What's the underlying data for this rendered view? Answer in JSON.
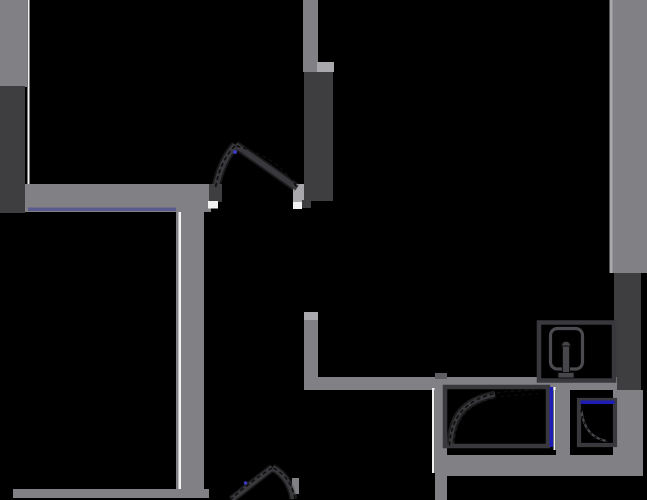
{
  "document": {
    "kind": "floor-plan",
    "width": 647,
    "height": 500,
    "background": "#000000"
  },
  "palette": {
    "bg": "#000000",
    "wall": "#818185",
    "wallLight": "#a9a9ad",
    "wallShadow": "#5f5f63",
    "dark": "#3e3e41",
    "white": "#f2f2f2",
    "purple": "#5a5a8e",
    "blue": "#1d1db5",
    "blueDot": "#3b3bc2",
    "black": "#000000",
    "stroke": "#39393d",
    "strokeLt": "#4a4a4f",
    "knob": "#46464b",
    "ink": "#0d0d0d",
    "halo": "#55555a"
  },
  "shapes": [
    {
      "type": "rect",
      "name": "wall-left-upper",
      "x": 0,
      "y": 0,
      "w": 27,
      "h": 87,
      "fill": "wall"
    },
    {
      "type": "rect",
      "name": "panel-left-dark",
      "x": 0,
      "y": 86,
      "w": 25,
      "h": 127,
      "fill": "dark"
    },
    {
      "type": "rect",
      "name": "wall-left-face-line",
      "x": 27.5,
      "y": 0,
      "w": 2,
      "h": 186,
      "fill": "white"
    },
    {
      "type": "rect",
      "name": "wall-entry-top",
      "x": 25,
      "y": 184,
      "w": 186,
      "h": 28,
      "fill": "wall"
    },
    {
      "type": "rect",
      "name": "accent-entry-purple",
      "x": 28,
      "y": 207.5,
      "w": 150,
      "h": 3.5,
      "fill": "purple"
    },
    {
      "type": "rect",
      "name": "wall-hall-vertical",
      "x": 176,
      "y": 205,
      "w": 28,
      "h": 293,
      "fill": "wall"
    },
    {
      "type": "rect",
      "name": "wall-hall-face-line",
      "x": 178.5,
      "y": 212,
      "w": 2.5,
      "h": 277,
      "fill": "white"
    },
    {
      "type": "rect",
      "name": "wall-bottom-left",
      "x": 13,
      "y": 489,
      "w": 196,
      "h": 9,
      "fill": "wall"
    },
    {
      "type": "rect",
      "name": "door1-jamb-left",
      "x": 209,
      "y": 184,
      "w": 13,
      "h": 18,
      "fill": "dark"
    },
    {
      "type": "rect",
      "name": "door1-sill-left",
      "x": 208,
      "y": 201,
      "w": 10,
      "h": 7.5,
      "fill": "white"
    },
    {
      "type": "rect",
      "name": "door1-jamb-right",
      "x": 293,
      "y": 184,
      "w": 18,
      "h": 18,
      "fill": "wallLight"
    },
    {
      "type": "rect",
      "name": "door1-sill-right",
      "x": 293,
      "y": 202,
      "w": 9,
      "h": 7,
      "fill": "white"
    },
    {
      "type": "rect",
      "name": "door1-jamb-right-dark",
      "x": 302,
      "y": 200,
      "w": 9,
      "h": 8,
      "fill": "dark"
    },
    {
      "type": "rect",
      "name": "wall-closet-top",
      "x": 303,
      "y": 0,
      "w": 15,
      "h": 72,
      "fill": "wall"
    },
    {
      "type": "rect",
      "name": "closet-cap",
      "x": 317,
      "y": 62,
      "w": 17,
      "h": 10,
      "fill": "wallLight"
    },
    {
      "type": "rect",
      "name": "panel-closet-dark",
      "x": 304,
      "y": 72,
      "w": 29,
      "h": 129,
      "fill": "dark"
    },
    {
      "type": "rect",
      "name": "wall-right-upper",
      "x": 612,
      "y": 0,
      "w": 35,
      "h": 273,
      "fill": "wall"
    },
    {
      "type": "rect",
      "name": "wall-right-face-line",
      "x": 609.5,
      "y": 0,
      "w": 3,
      "h": 273,
      "fill": "wallLight"
    },
    {
      "type": "rect",
      "name": "panel-right-dark",
      "x": 614,
      "y": 273,
      "w": 27,
      "h": 124,
      "fill": "dark"
    },
    {
      "type": "rect",
      "name": "wall-bath-corner-vertical",
      "x": 304,
      "y": 312,
      "w": 14,
      "h": 78,
      "fill": "wall"
    },
    {
      "type": "rect",
      "name": "bath-corner-cap",
      "x": 304,
      "y": 312,
      "w": 14,
      "h": 8,
      "fill": "wallLight"
    },
    {
      "type": "rect",
      "name": "wall-bath-top",
      "x": 310,
      "y": 377,
      "w": 307,
      "h": 13,
      "fill": "wall"
    },
    {
      "type": "rect",
      "name": "wall-bath-mid-vertical",
      "x": 435,
      "y": 373,
      "w": 12,
      "h": 127,
      "fill": "wall"
    },
    {
      "type": "rect",
      "name": "bath-mid-cap",
      "x": 435,
      "y": 373,
      "w": 12,
      "h": 6,
      "fill": "wallShadow"
    },
    {
      "type": "rect",
      "name": "wall-bath-mid-face-line",
      "x": 432,
      "y": 388,
      "w": 2.5,
      "h": 85,
      "fill": "white"
    },
    {
      "type": "rect",
      "name": "wall-bath-bottom",
      "x": 437,
      "y": 455,
      "w": 206,
      "h": 21,
      "fill": "wall"
    },
    {
      "type": "rect",
      "name": "wall-bath-right-lower",
      "x": 613,
      "y": 390,
      "w": 30,
      "h": 70,
      "fill": "wall"
    },
    {
      "type": "rect",
      "name": "wall-bath-divider",
      "x": 556,
      "y": 385,
      "w": 14,
      "h": 73,
      "fill": "wall"
    },
    {
      "type": "rect",
      "name": "bath-divider-face-line",
      "x": 553.5,
      "y": 387,
      "w": 2,
      "h": 63,
      "fill": "white"
    },
    {
      "type": "rect",
      "name": "door2-jamb-right",
      "x": 292,
      "y": 478,
      "w": 7,
      "h": 16,
      "fill": "wall"
    },
    {
      "type": "rect",
      "name": "washer-outline",
      "x": 539,
      "y": 322.5,
      "w": 75,
      "h": 58,
      "fill": "black",
      "stroke": "stroke",
      "sw": 4.5
    },
    {
      "type": "rect",
      "name": "washer-drum",
      "x": 550.5,
      "y": 328.5,
      "w": 32,
      "h": 40.5,
      "rx": 7,
      "fill": "black",
      "stroke": "strokeLt",
      "sw": 3.2
    },
    {
      "type": "circle",
      "name": "washer-knob-head",
      "cx": 566,
      "cy": 346,
      "r": 4.6,
      "fill": "knob",
      "stroke": "ink",
      "sw": 1
    },
    {
      "type": "rect",
      "name": "washer-knob-stem",
      "x": 562.5,
      "y": 346,
      "w": 7,
      "h": 27,
      "fill": "knob",
      "stroke": "ink",
      "sw": 1
    },
    {
      "type": "rect",
      "name": "washer-knob-base",
      "x": 558,
      "y": 372.5,
      "w": 16,
      "h": 5.5,
      "fill": "knob",
      "stroke": "ink",
      "sw": 1
    },
    {
      "type": "rect",
      "name": "shower-outline",
      "x": 445,
      "y": 387,
      "w": 103,
      "h": 59,
      "fill": "black",
      "stroke": "stroke",
      "sw": 4.5
    },
    {
      "type": "rect",
      "name": "shower-glass-blue",
      "x": 549.5,
      "y": 387,
      "w": 3.5,
      "h": 60,
      "fill": "blue"
    },
    {
      "type": "path",
      "name": "shower-door-halo",
      "d": "M450.5 444 C452 418 462 401 495 394.5",
      "stroke": "halo",
      "sw": 8,
      "opacity": 0.35
    },
    {
      "type": "path",
      "name": "shower-door-leaf",
      "d": "M450.5 444 C452 418 462 401 495 394.5",
      "stroke": "stroke",
      "sw": 4
    },
    {
      "type": "path",
      "name": "shower-door-arc-dash",
      "d": "M449.5 445.5 C451.5 413 469 396.5 506 391.5 L544.5 389.5",
      "stroke": "ink",
      "sw": 1.6,
      "dash": "4 3"
    },
    {
      "type": "path",
      "name": "shower-door-arc-dash2",
      "d": "M453.5 441 C457 417 471 402.5 500 396.5 L540 393.5",
      "stroke": "ink",
      "sw": 1.2,
      "dash": "3 4"
    },
    {
      "type": "rect",
      "name": "sink-outline",
      "x": 579,
      "y": 400,
      "w": 36,
      "h": 45,
      "fill": "black",
      "stroke": "stroke",
      "sw": 4.2
    },
    {
      "type": "rect",
      "name": "sink-glass-blue",
      "x": 580.5,
      "y": 400.5,
      "w": 34,
      "h": 3.5,
      "fill": "blue"
    },
    {
      "type": "path",
      "name": "sink-door-leaf",
      "d": "M581.5 411 Q584.5 436.5 606 441",
      "stroke": "strokeLt",
      "sw": 2.2
    },
    {
      "type": "path",
      "name": "sink-door-arc-dash",
      "d": "M581 410 Q585.5 438.5 608.5 441.5",
      "stroke": "ink",
      "sw": 1.3,
      "dash": "3 3"
    },
    {
      "type": "path",
      "name": "door1-halo-left",
      "d": "M235.5 145 Q222 160 216 186",
      "stroke": "halo",
      "sw": 9,
      "opacity": 0.3
    },
    {
      "type": "path",
      "name": "door1-halo-right",
      "d": "M235.5 145 L297 188",
      "stroke": "halo",
      "sw": 9,
      "opacity": 0.3
    },
    {
      "type": "path",
      "name": "door1-leaf-left",
      "d": "M235.5 145 Q222 160 216 186",
      "stroke": "stroke",
      "sw": 5.5
    },
    {
      "type": "path",
      "name": "door1-leaf-right",
      "d": "M235.5 145 L297 188",
      "stroke": "stroke",
      "sw": 5.5
    },
    {
      "type": "path",
      "name": "door1-arc-dash-left",
      "d": "M235 146 Q220.5 160 215.5 187.5",
      "stroke": "ink",
      "sw": 1.6,
      "dash": "4 3"
    },
    {
      "type": "path",
      "name": "door1-arc-dash-right",
      "d": "M236.5 146 Q278 156.5 298 189",
      "stroke": "ink",
      "sw": 1.6,
      "dash": "4 3"
    },
    {
      "type": "circle",
      "name": "door1-pivot-dot",
      "cx": 235,
      "cy": 152,
      "r": 2,
      "fill": "blueDot"
    },
    {
      "type": "path",
      "name": "door2-halo-left",
      "d": "M272.5 467.5 L231.5 499.5",
      "stroke": "halo",
      "sw": 8,
      "opacity": 0.3
    },
    {
      "type": "path",
      "name": "door2-halo-right",
      "d": "M272.5 467.5 Q290 477.5 293.5 499",
      "stroke": "halo",
      "sw": 8,
      "opacity": 0.3
    },
    {
      "type": "path",
      "name": "door2-leaf-left",
      "d": "M272.5 467.5 L231.5 499.5",
      "stroke": "stroke",
      "sw": 5
    },
    {
      "type": "path",
      "name": "door2-leaf-right",
      "d": "M272.5 467.5 Q290 477.5 293.5 499",
      "stroke": "stroke",
      "sw": 5
    },
    {
      "type": "path",
      "name": "door2-arc-dash-left",
      "d": "M272 468 Q251 481 230 500",
      "stroke": "ink",
      "sw": 1.5,
      "dash": "4 3"
    },
    {
      "type": "path",
      "name": "door2-arc-dash-right",
      "d": "M273.5 468 Q292.5 479 295 500",
      "stroke": "ink",
      "sw": 1.5,
      "dash": "4 3"
    },
    {
      "type": "circle",
      "name": "door2-pivot-dot",
      "cx": 245.5,
      "cy": 483,
      "r": 1.8,
      "fill": "blueDot"
    }
  ]
}
